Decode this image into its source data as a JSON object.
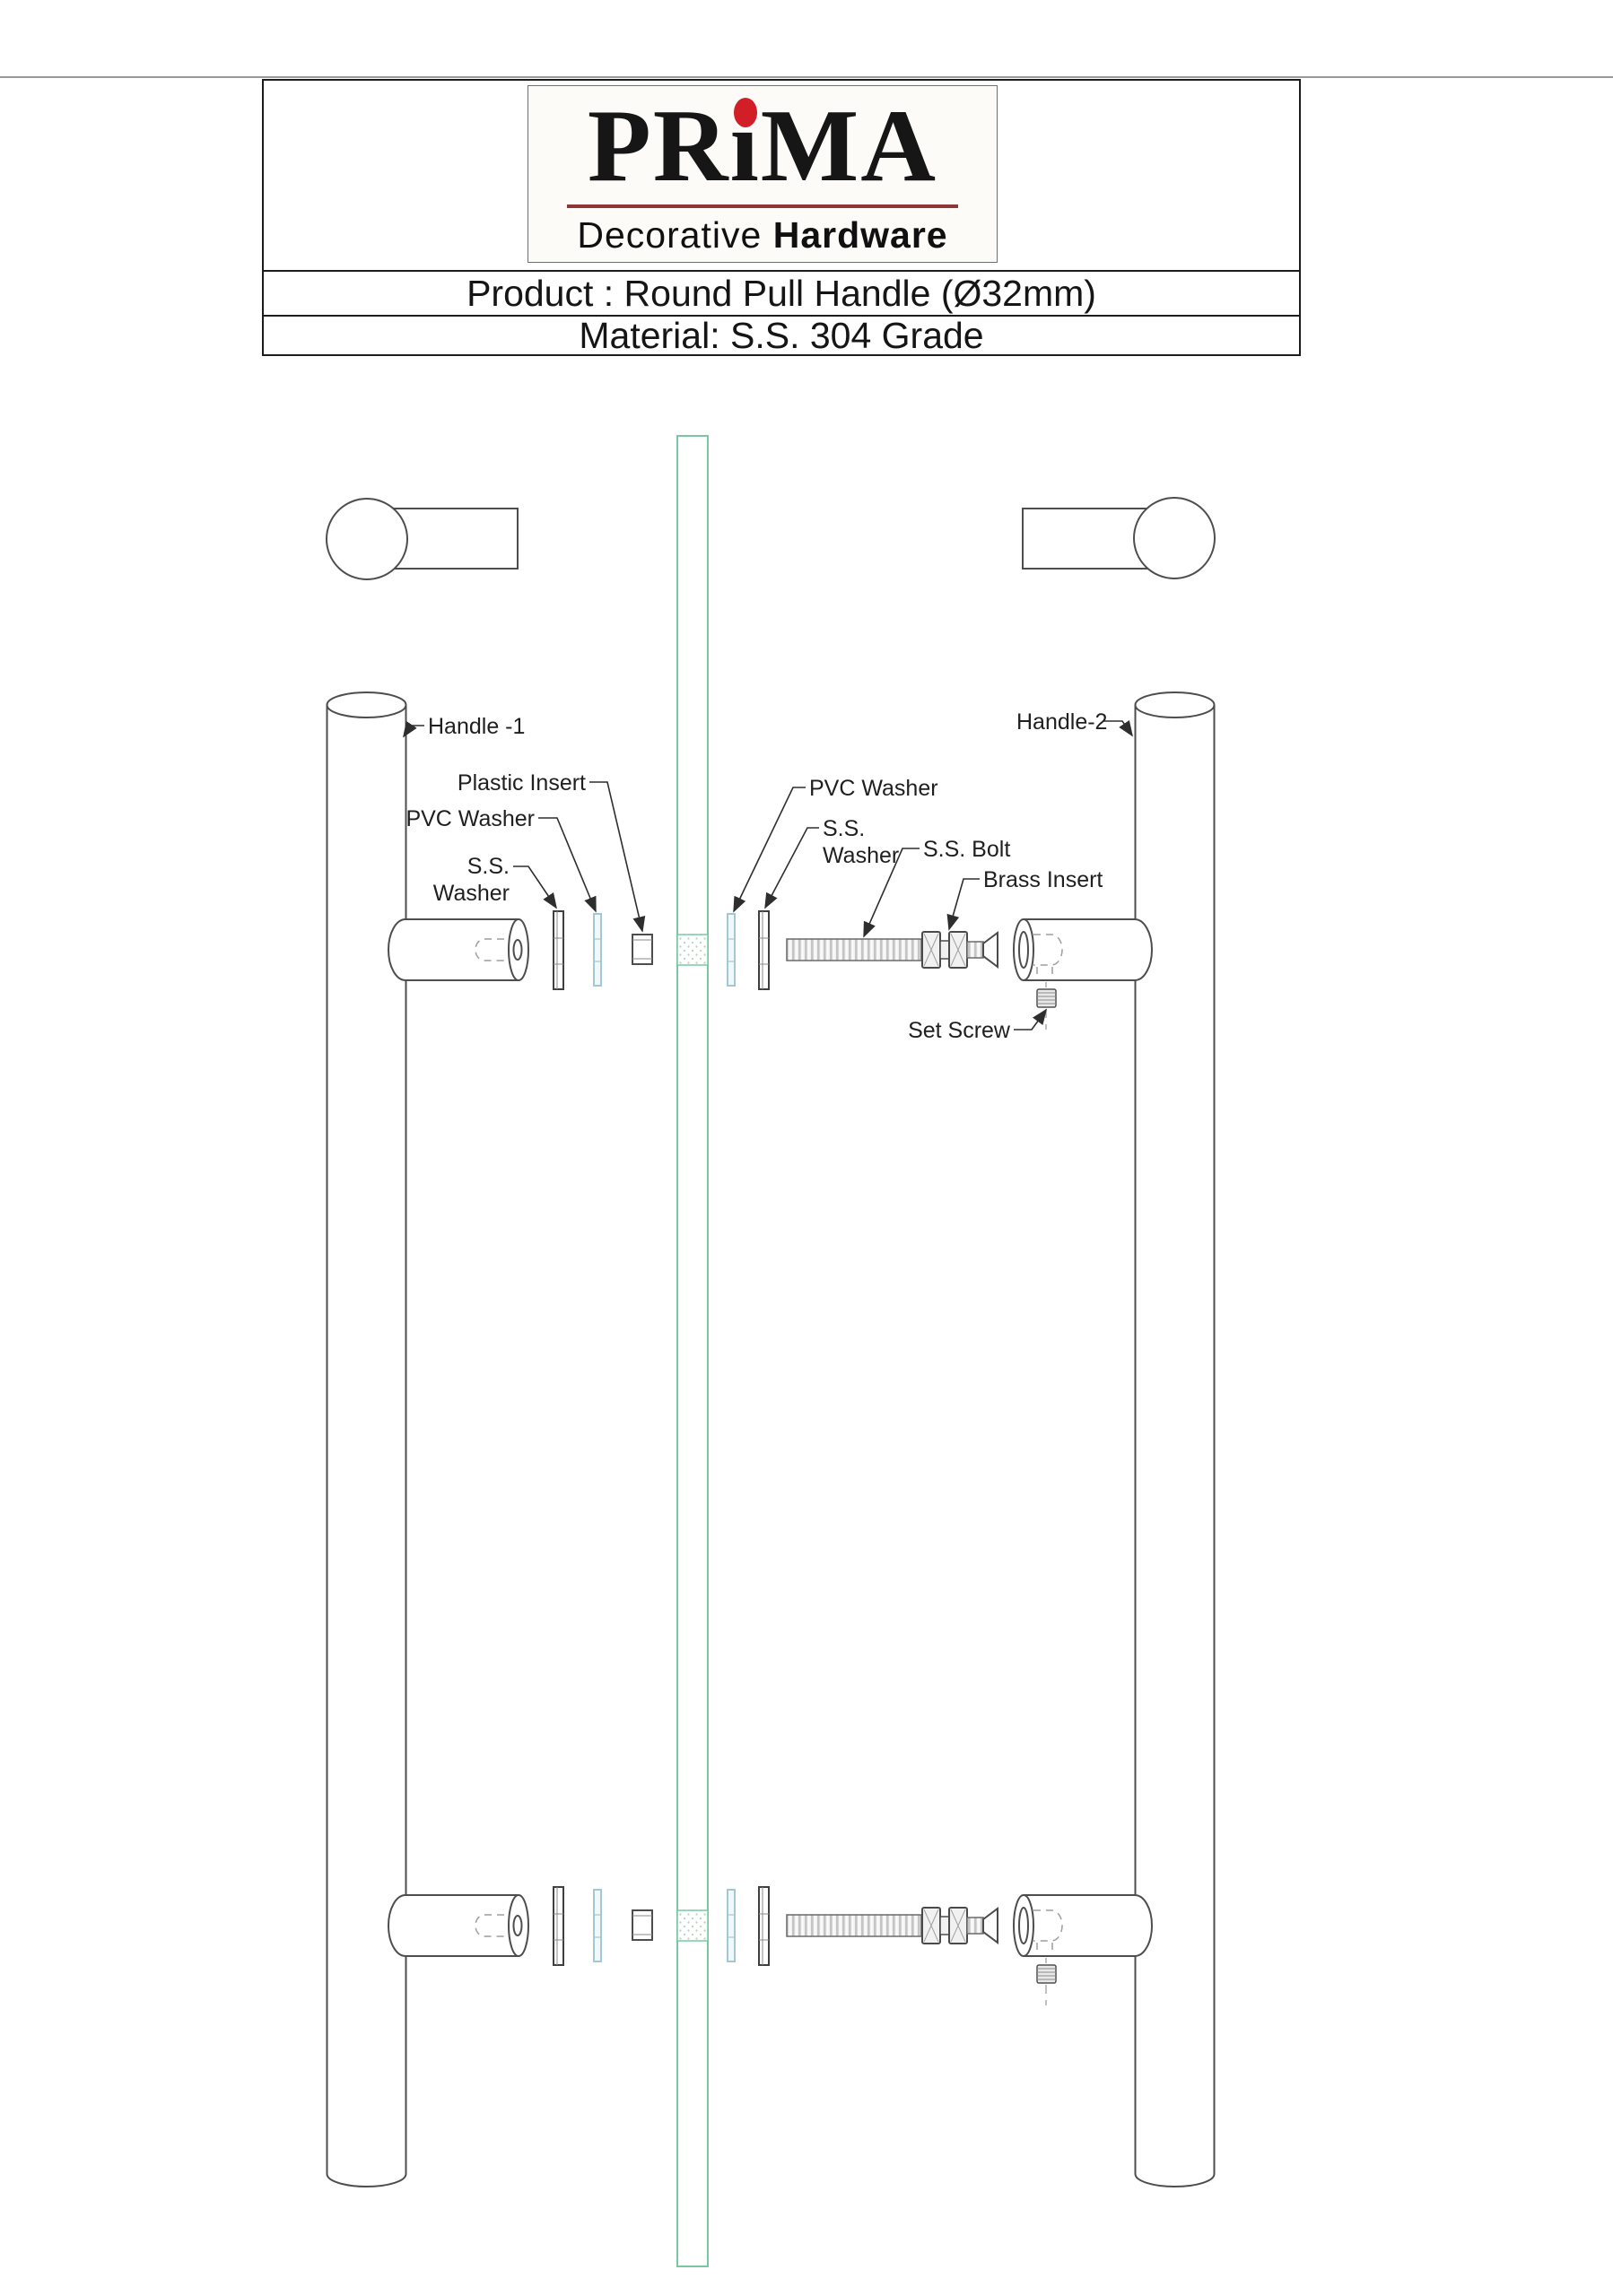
{
  "header": {
    "logo": {
      "brand": "PRiMA",
      "part_pr": "PR",
      "part_i": "ı",
      "part_ma": "MA",
      "tagline_regular": "Decorative",
      "tagline_bold": "Hardware",
      "dot_color": "#d21e26",
      "rule_color": "#8e3538"
    },
    "product_row": "Product : Round Pull Handle (Ø32mm)",
    "material_row": "Material: S.S. 304 Grade"
  },
  "diagram": {
    "labels": {
      "handle1": "Handle -1",
      "handle2": "Handle-2",
      "plastic_insert": "Plastic Insert",
      "pvc_washer_left": "PVC Washer",
      "ss_washer_left_1": "S.S.",
      "ss_washer_left_2": "Washer",
      "pvc_washer_right": "PVC Washer",
      "ss_washer_right_1": "S.S.",
      "ss_washer_right_2": "Washer",
      "ss_bolt": "S.S. Bolt",
      "brass_insert": "Brass Insert",
      "set_screw": "Set Screw"
    },
    "colors": {
      "glass_green": "#79c8a2",
      "glass_dots": "#a6d9bf",
      "pvc_blue": "#a3c7d3",
      "line_gray": "#4d4d4d",
      "label_ink": "#1f1f1f",
      "leader_ink": "#2e2e2e"
    }
  }
}
